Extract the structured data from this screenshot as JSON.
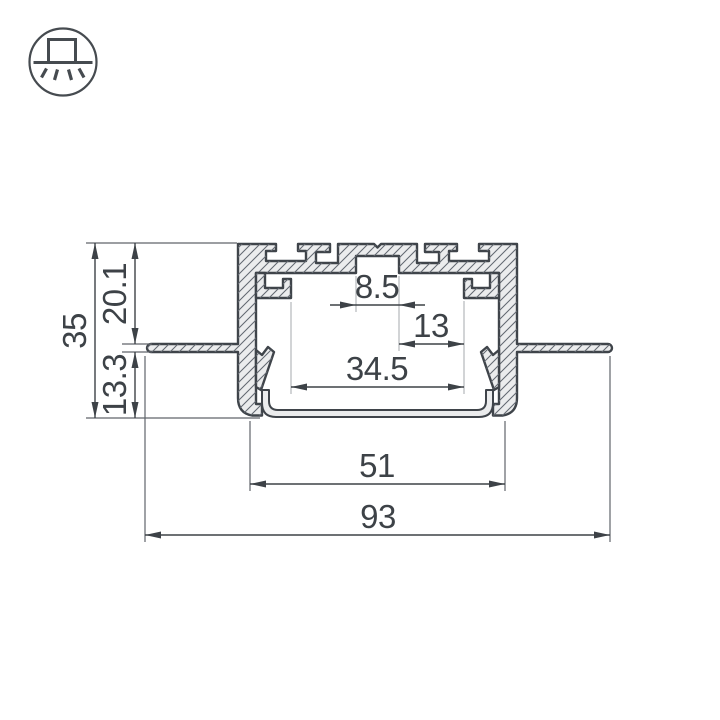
{
  "icon": {
    "name": "recessed-profile-downlight-icon",
    "description": "circle with recessed profile emitting light downward"
  },
  "drawing": {
    "title": "aluminium-led-profile-cross-section",
    "units": "mm",
    "colors": {
      "outline": "#3f444a",
      "fill": "#ebeced",
      "hatch": "#626870",
      "dimension": "#3d4247",
      "extension_dark": "#60656b",
      "extension_light": "#b4b7ba"
    },
    "dimensions": {
      "overall_width": {
        "value": "93",
        "orientation": "horizontal"
      },
      "body_width": {
        "value": "51",
        "orientation": "horizontal"
      },
      "inner_width": {
        "value": "34.5",
        "orientation": "horizontal"
      },
      "slot_offset": {
        "value": "13",
        "orientation": "horizontal"
      },
      "slot_width": {
        "value": "8.5",
        "orientation": "horizontal"
      },
      "overall_height": {
        "value": "35",
        "orientation": "vertical"
      },
      "upper_height": {
        "value": "20.1",
        "orientation": "vertical"
      },
      "lower_height": {
        "value": "13.3",
        "orientation": "vertical"
      }
    }
  }
}
